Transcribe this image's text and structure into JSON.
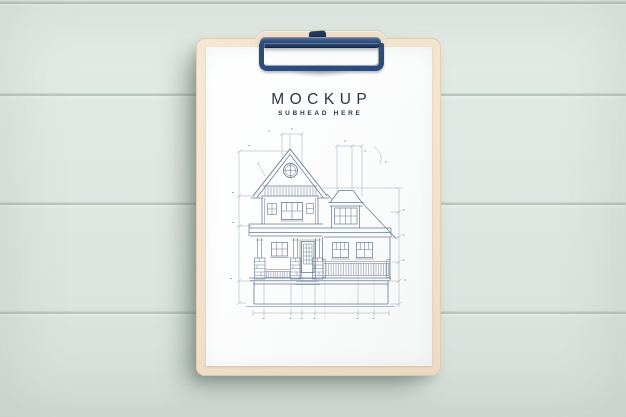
{
  "scene": {
    "description": "Top-down photo mockup of a clipboard on a pastel mint painted wood plank wall",
    "background": {
      "surface": "horizontal wood planks",
      "color": "#dfe8e2",
      "plank_line_color": "#aebcb1",
      "plank_line_ys": [
        2,
        94,
        203,
        312
      ]
    },
    "clipboard": {
      "board_color": "#f3e3cf",
      "clip_color": "#2e4c78",
      "clip_type": "metal spring clip with lever"
    }
  },
  "paper": {
    "color": "#fcfcfd",
    "title": "MOCKUP",
    "subhead": "SUBHEAD HERE",
    "text_color": "#2d3541",
    "illustration": {
      "type": "architectural-elevation-drawing",
      "subject": "Two-story house front elevation: steep gable roof with round attic window, shingle band, hipped dormer, columned porch with brick piers, central glazed door, balustrades, foundation, and dimension/construction lines",
      "line_color": "#6a7a92",
      "dimension_line_color": "#8f9cb0"
    }
  }
}
